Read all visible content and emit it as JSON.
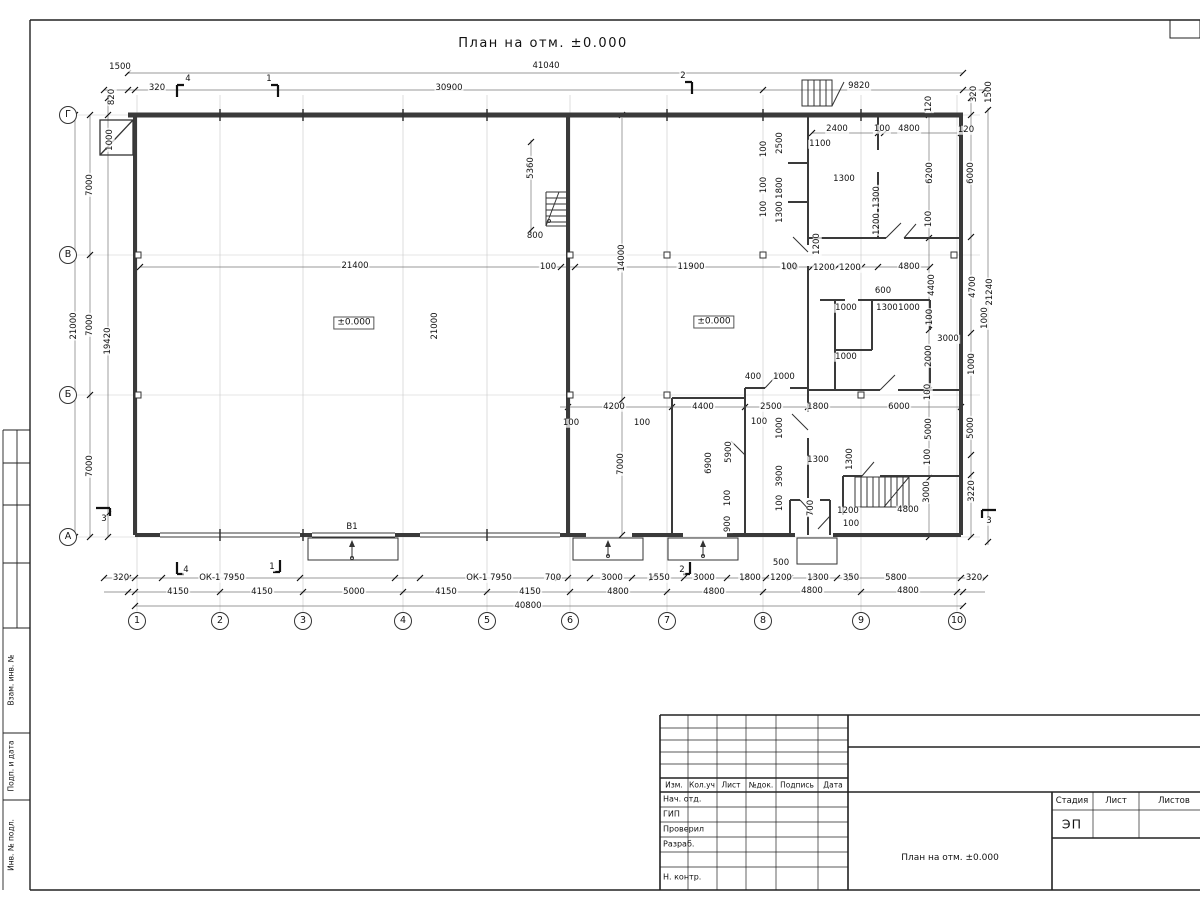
{
  "page": {
    "title": "План на отм. ±0.000"
  },
  "plan": {
    "axes_bottom": [
      {
        "n": "1",
        "x": 137
      },
      {
        "n": "2",
        "x": 220
      },
      {
        "n": "3",
        "x": 303
      },
      {
        "n": "4",
        "x": 403
      },
      {
        "n": "5",
        "x": 487
      },
      {
        "n": "6",
        "x": 570
      },
      {
        "n": "7",
        "x": 667
      },
      {
        "n": "8",
        "x": 763
      },
      {
        "n": "9",
        "x": 861
      },
      {
        "n": "10",
        "x": 957
      }
    ],
    "axes_left": [
      {
        "n": "Г",
        "y": 115
      },
      {
        "n": "В",
        "y": 255
      },
      {
        "n": "Б",
        "y": 395
      },
      {
        "n": "А",
        "y": 537
      }
    ],
    "dims": [
      {
        "t": "41040",
        "x": 546,
        "y": 66
      },
      {
        "t": "1500",
        "x": 120,
        "y": 67
      },
      {
        "t": "320",
        "x": 157,
        "y": 88
      },
      {
        "t": "30900",
        "x": 449,
        "y": 88
      },
      {
        "t": "9820",
        "x": 859,
        "y": 86
      },
      {
        "t": "820",
        "x": 112,
        "y": 97,
        "v": 1
      },
      {
        "t": "1000",
        "x": 110,
        "y": 140,
        "v": 1
      },
      {
        "t": "120",
        "x": 929,
        "y": 104,
        "v": 1
      },
      {
        "t": "320",
        "x": 974,
        "y": 94,
        "v": 1
      },
      {
        "t": "1500",
        "x": 989,
        "y": 92,
        "v": 1
      },
      {
        "t": "7000",
        "x": 90,
        "y": 185,
        "v": 1
      },
      {
        "t": "7000",
        "x": 90,
        "y": 325,
        "v": 1
      },
      {
        "t": "7000",
        "x": 90,
        "y": 466,
        "v": 1
      },
      {
        "t": "21000",
        "x": 74,
        "y": 326,
        "v": 1
      },
      {
        "t": "19420",
        "x": 108,
        "y": 341,
        "v": 1
      },
      {
        "t": "6000",
        "x": 971,
        "y": 173,
        "v": 1
      },
      {
        "t": "4700",
        "x": 973,
        "y": 287,
        "v": 1
      },
      {
        "t": "21240",
        "x": 990,
        "y": 292,
        "v": 1
      },
      {
        "t": "1000",
        "x": 985,
        "y": 318,
        "v": 1
      },
      {
        "t": "1000",
        "x": 972,
        "y": 364,
        "v": 1
      },
      {
        "t": "5000",
        "x": 971,
        "y": 428,
        "v": 1
      },
      {
        "t": "3220",
        "x": 972,
        "y": 491,
        "v": 1
      },
      {
        "t": "6200",
        "x": 930,
        "y": 173,
        "v": 1
      },
      {
        "t": "100",
        "x": 929,
        "y": 219,
        "v": 1
      },
      {
        "t": "4400",
        "x": 932,
        "y": 285,
        "v": 1
      },
      {
        "t": "100",
        "x": 930,
        "y": 317,
        "v": 1
      },
      {
        "t": "2000",
        "x": 929,
        "y": 356,
        "v": 1
      },
      {
        "t": "100",
        "x": 928,
        "y": 392,
        "v": 1
      },
      {
        "t": "5000",
        "x": 929,
        "y": 429,
        "v": 1
      },
      {
        "t": "100",
        "x": 928,
        "y": 457,
        "v": 1
      },
      {
        "t": "3000",
        "x": 927,
        "y": 492,
        "v": 1
      },
      {
        "t": "2400",
        "x": 837,
        "y": 129
      },
      {
        "t": "100",
        "x": 882,
        "y": 129
      },
      {
        "t": "4800",
        "x": 909,
        "y": 129
      },
      {
        "t": "120",
        "x": 966,
        "y": 130
      },
      {
        "t": "1100",
        "x": 820,
        "y": 144
      },
      {
        "t": "2500",
        "x": 780,
        "y": 143,
        "v": 1
      },
      {
        "t": "100",
        "x": 764,
        "y": 149,
        "v": 1
      },
      {
        "t": "1800",
        "x": 780,
        "y": 188,
        "v": 1
      },
      {
        "t": "100",
        "x": 764,
        "y": 185,
        "v": 1
      },
      {
        "t": "1300",
        "x": 780,
        "y": 212,
        "v": 1
      },
      {
        "t": "100",
        "x": 764,
        "y": 209,
        "v": 1
      },
      {
        "t": "1300",
        "x": 844,
        "y": 179
      },
      {
        "t": "1300",
        "x": 877,
        "y": 197,
        "v": 1
      },
      {
        "t": "1200",
        "x": 877,
        "y": 224,
        "v": 1
      },
      {
        "t": "1200",
        "x": 817,
        "y": 244,
        "v": 1
      },
      {
        "t": "100",
        "x": 790,
        "y": 268
      },
      {
        "t": "1200",
        "x": 824,
        "y": 268
      },
      {
        "t": "1200",
        "x": 850,
        "y": 268
      },
      {
        "t": "4800",
        "x": 909,
        "y": 267
      },
      {
        "t": "600",
        "x": 883,
        "y": 291
      },
      {
        "t": "1000",
        "x": 846,
        "y": 308
      },
      {
        "t": "1300",
        "x": 887,
        "y": 308
      },
      {
        "t": "1000",
        "x": 909,
        "y": 308
      },
      {
        "t": "3000",
        "x": 948,
        "y": 339
      },
      {
        "t": "1000",
        "x": 846,
        "y": 357
      },
      {
        "t": "5360",
        "x": 531,
        "y": 168,
        "v": 1
      },
      {
        "t": "800",
        "x": 535,
        "y": 236
      },
      {
        "t": "14000",
        "x": 622,
        "y": 258,
        "v": 1
      },
      {
        "t": "21400",
        "x": 355,
        "y": 266
      },
      {
        "t": "100",
        "x": 548,
        "y": 267
      },
      {
        "t": "11900",
        "x": 691,
        "y": 267
      },
      {
        "t": "100",
        "x": 789,
        "y": 267
      },
      {
        "t": "21000",
        "x": 435,
        "y": 326,
        "v": 1
      },
      {
        "t": "±0.000",
        "x": 354,
        "y": 323,
        "b": 1
      },
      {
        "t": "±0.000",
        "x": 714,
        "y": 322,
        "b": 1
      },
      {
        "t": "400",
        "x": 753,
        "y": 377
      },
      {
        "t": "1000",
        "x": 784,
        "y": 377
      },
      {
        "t": "4200",
        "x": 614,
        "y": 407
      },
      {
        "t": "100",
        "x": 571,
        "y": 423
      },
      {
        "t": "100",
        "x": 642,
        "y": 423
      },
      {
        "t": "4400",
        "x": 703,
        "y": 407
      },
      {
        "t": "2500",
        "x": 771,
        "y": 407
      },
      {
        "t": "1800",
        "x": 818,
        "y": 407
      },
      {
        "t": "6000",
        "x": 899,
        "y": 407
      },
      {
        "t": "100",
        "x": 759,
        "y": 422
      },
      {
        "t": "1000",
        "x": 780,
        "y": 428,
        "v": 1
      },
      {
        "t": "7000",
        "x": 621,
        "y": 464,
        "v": 1
      },
      {
        "t": "6900",
        "x": 709,
        "y": 463,
        "v": 1
      },
      {
        "t": "5900",
        "x": 729,
        "y": 452,
        "v": 1
      },
      {
        "t": "100",
        "x": 728,
        "y": 498,
        "v": 1
      },
      {
        "t": "900",
        "x": 728,
        "y": 524,
        "v": 1
      },
      {
        "t": "3900",
        "x": 780,
        "y": 476,
        "v": 1
      },
      {
        "t": "100",
        "x": 780,
        "y": 503,
        "v": 1
      },
      {
        "t": "700",
        "x": 811,
        "y": 508,
        "v": 1
      },
      {
        "t": "1300",
        "x": 818,
        "y": 460
      },
      {
        "t": "1300",
        "x": 850,
        "y": 459,
        "v": 1
      },
      {
        "t": "1200",
        "x": 848,
        "y": 511
      },
      {
        "t": "100",
        "x": 851,
        "y": 524
      },
      {
        "t": "4800",
        "x": 908,
        "y": 510
      },
      {
        "t": "320",
        "x": 121,
        "y": 578
      },
      {
        "t": "ОК-1 7950",
        "x": 222,
        "y": 578
      },
      {
        "t": "ОК-1 7950",
        "x": 489,
        "y": 578
      },
      {
        "t": "700",
        "x": 553,
        "y": 578
      },
      {
        "t": "3000",
        "x": 612,
        "y": 578
      },
      {
        "t": "1550",
        "x": 659,
        "y": 578
      },
      {
        "t": "3000",
        "x": 704,
        "y": 578
      },
      {
        "t": "1800",
        "x": 750,
        "y": 578
      },
      {
        "t": "500",
        "x": 781,
        "y": 563
      },
      {
        "t": "1200",
        "x": 781,
        "y": 578
      },
      {
        "t": "1300",
        "x": 818,
        "y": 578
      },
      {
        "t": "350",
        "x": 851,
        "y": 578
      },
      {
        "t": "5800",
        "x": 896,
        "y": 578
      },
      {
        "t": "320",
        "x": 974,
        "y": 578
      },
      {
        "t": "4150",
        "x": 178,
        "y": 592
      },
      {
        "t": "4150",
        "x": 262,
        "y": 592
      },
      {
        "t": "5000",
        "x": 354,
        "y": 592
      },
      {
        "t": "4150",
        "x": 446,
        "y": 592
      },
      {
        "t": "4150",
        "x": 530,
        "y": 592
      },
      {
        "t": "4800",
        "x": 618,
        "y": 592
      },
      {
        "t": "4800",
        "x": 714,
        "y": 592
      },
      {
        "t": "4800",
        "x": 812,
        "y": 591
      },
      {
        "t": "4800",
        "x": 908,
        "y": 591
      },
      {
        "t": "40800",
        "x": 528,
        "y": 606
      },
      {
        "t": "В1",
        "x": 352,
        "y": 527
      },
      {
        "t": "4",
        "x": 188,
        "y": 79
      },
      {
        "t": "1",
        "x": 269,
        "y": 79
      },
      {
        "t": "2",
        "x": 683,
        "y": 76
      },
      {
        "t": "4",
        "x": 186,
        "y": 570
      },
      {
        "t": "1",
        "x": 272,
        "y": 567
      },
      {
        "t": "2",
        "x": 682,
        "y": 570
      },
      {
        "t": "3",
        "x": 104,
        "y": 519
      },
      {
        "t": "3",
        "x": 989,
        "y": 521
      }
    ]
  },
  "stamp": {
    "header": [
      "Изм.",
      "Кол.уч",
      "Лист",
      "№док.",
      "Подпись",
      "Дата"
    ],
    "rows": [
      "Нач. отд.",
      "ГИП",
      "Проверил",
      "Разраб.",
      "",
      "Н. контр."
    ],
    "stage_label": "Стадия",
    "sheet_label": "Лист",
    "sheets_label": "Листов",
    "stage": "ЭП",
    "title": "План на отм. ±0.000"
  },
  "side_strip": {
    "labels": [
      {
        "t": "Взам. инв. №",
        "y": 680
      },
      {
        "t": "Подп. и дата",
        "y": 766
      },
      {
        "t": "Инв. № подл.",
        "y": 845
      }
    ]
  }
}
